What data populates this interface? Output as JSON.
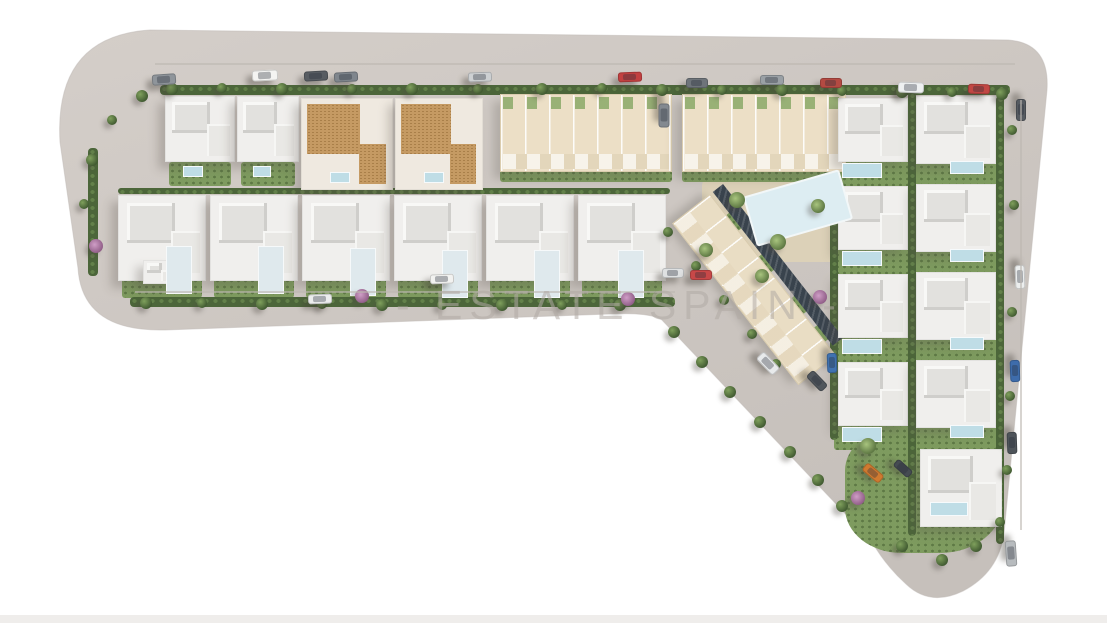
{
  "watermark": {
    "text": "- ESTATE SPAIN -"
  },
  "palette": {
    "background": "#ffffff",
    "pavement": "#cdc7c2",
    "pavement_light": "#d6d0cb",
    "villa_white": "#f0efed",
    "terracotta_roof": "#c59a63",
    "townhouse_cream": "#ecdfc6",
    "apartment_cream": "#e9ddc4",
    "dark_roof_band": "#39434d",
    "hedge_green": "#4c663a",
    "lawn_green": "#7e9b5f",
    "pool_blue": "#bfdde6",
    "communal_pool_blue": "#ddedf2",
    "watermark_gray": "rgba(176,170,164,0.55)"
  },
  "scene": {
    "land_path": "M150,30 L1008,40 Q1050,43 1047,90 L1004,533 Q999,572 963,591 Q930,607 906,584 Q886,566 872,542 L662,320 Q650,312 610,314 L165,330 Q82,332 78,268 L60,142 Q54,36 150,30 Z",
    "deck": [
      702,
      176,
      162,
      86,
      0
    ],
    "lawns": [
      [
        169,
        162,
        62,
        24
      ],
      [
        241,
        162,
        54,
        24
      ],
      [
        305,
        168,
        84,
        22
      ],
      [
        399,
        168,
        80,
        22
      ],
      [
        500,
        170,
        172,
        12
      ],
      [
        682,
        170,
        164,
        12
      ],
      [
        122,
        278,
        80,
        20
      ],
      [
        214,
        278,
        80,
        20
      ],
      [
        306,
        278,
        80,
        20
      ],
      [
        398,
        278,
        80,
        20
      ],
      [
        490,
        278,
        80,
        20
      ],
      [
        582,
        278,
        80,
        20
      ],
      [
        834,
        158,
        170,
        28
      ],
      [
        834,
        246,
        170,
        28
      ],
      [
        834,
        334,
        170,
        28
      ],
      [
        834,
        422,
        170,
        28
      ],
      [
        848,
        190,
        30,
        56
      ],
      [
        726,
        214,
        20,
        12,
        52
      ],
      [
        758,
        256,
        20,
        12,
        52
      ],
      [
        790,
        298,
        20,
        12,
        52
      ],
      [
        812,
        328,
        18,
        11,
        52
      ]
    ],
    "lawns_round": [
      [
        845,
        428,
        158,
        125
      ]
    ],
    "hedges": [
      [
        160,
        85,
        850,
        10
      ],
      [
        118,
        188,
        552,
        6
      ],
      [
        130,
        297,
        545,
        10
      ],
      [
        88,
        148,
        10,
        128
      ],
      [
        830,
        92,
        8,
        348
      ],
      [
        908,
        92,
        8,
        444
      ],
      [
        996,
        96,
        8,
        448
      ]
    ],
    "townhouses": [
      [
        500,
        94,
        172,
        78
      ],
      [
        682,
        94,
        164,
        78
      ]
    ],
    "apartment": [
      710,
      194,
      205,
      48,
      52
    ],
    "darkband": [
      723,
      184,
      195,
      13,
      52
    ],
    "villas": [
      [
        165,
        96,
        70,
        66,
        "w"
      ],
      [
        237,
        96,
        62,
        66,
        "w"
      ],
      [
        301,
        98,
        92,
        92,
        "t"
      ],
      [
        395,
        98,
        88,
        92,
        "t"
      ],
      [
        118,
        195,
        88,
        86,
        "w"
      ],
      [
        210,
        195,
        88,
        86,
        "w"
      ],
      [
        302,
        195,
        88,
        86,
        "w"
      ],
      [
        394,
        195,
        88,
        86,
        "w"
      ],
      [
        486,
        195,
        88,
        86,
        "w"
      ],
      [
        578,
        195,
        88,
        86,
        "w"
      ],
      [
        838,
        98,
        70,
        64,
        "w"
      ],
      [
        838,
        186,
        70,
        64,
        "w"
      ],
      [
        838,
        274,
        70,
        64,
        "w"
      ],
      [
        838,
        362,
        70,
        64,
        "w"
      ],
      [
        916,
        96,
        80,
        68,
        "w"
      ],
      [
        916,
        184,
        80,
        68,
        "w"
      ],
      [
        916,
        272,
        80,
        68,
        "w"
      ],
      [
        916,
        360,
        80,
        68,
        "w"
      ],
      [
        920,
        449,
        82,
        78,
        "w"
      ],
      [
        143,
        260,
        30,
        24,
        "w"
      ]
    ],
    "patios": [
      [
        166,
        246,
        26,
        48
      ],
      [
        258,
        246,
        26,
        48
      ],
      [
        350,
        248,
        26,
        48
      ],
      [
        442,
        250,
        26,
        48
      ],
      [
        534,
        250,
        26,
        48
      ],
      [
        618,
        250,
        26,
        48
      ]
    ],
    "pools": [
      [
        183,
        166,
        20,
        11
      ],
      [
        253,
        166,
        18,
        11
      ],
      [
        330,
        172,
        20,
        11
      ],
      [
        424,
        172,
        20,
        11
      ],
      [
        842,
        163,
        40,
        15
      ],
      [
        842,
        251,
        40,
        15
      ],
      [
        842,
        339,
        40,
        15
      ],
      [
        842,
        427,
        40,
        15
      ],
      [
        950,
        161,
        34,
        13
      ],
      [
        950,
        249,
        34,
        13
      ],
      [
        950,
        337,
        34,
        13
      ],
      [
        950,
        425,
        34,
        13
      ],
      [
        930,
        502,
        38,
        14
      ]
    ],
    "bigpool": [
      748,
      182,
      100,
      52,
      -16
    ],
    "trees": [
      [
        172,
        89,
        6,
        "g"
      ],
      [
        222,
        88,
        5,
        "g"
      ],
      [
        282,
        89,
        6,
        "g"
      ],
      [
        352,
        89,
        5,
        "g"
      ],
      [
        412,
        89,
        6,
        "g"
      ],
      [
        478,
        89,
        5,
        "g"
      ],
      [
        542,
        89,
        6,
        "g"
      ],
      [
        602,
        88,
        5,
        "g"
      ],
      [
        662,
        90,
        6,
        "g"
      ],
      [
        722,
        90,
        5,
        "g"
      ],
      [
        782,
        90,
        6,
        "g"
      ],
      [
        842,
        91,
        5,
        "g"
      ],
      [
        902,
        92,
        6,
        "g"
      ],
      [
        952,
        92,
        5,
        "g"
      ],
      [
        1002,
        94,
        6,
        "g"
      ],
      [
        146,
        303,
        6,
        "g"
      ],
      [
        202,
        303,
        5,
        "g"
      ],
      [
        262,
        304,
        6,
        "g"
      ],
      [
        322,
        304,
        5,
        "g"
      ],
      [
        382,
        305,
        6,
        "g"
      ],
      [
        442,
        305,
        5,
        "g"
      ],
      [
        502,
        305,
        6,
        "g"
      ],
      [
        562,
        305,
        5,
        "g"
      ],
      [
        620,
        305,
        6,
        "g"
      ],
      [
        362,
        296,
        7,
        "k"
      ],
      [
        628,
        299,
        7,
        "k"
      ],
      [
        820,
        297,
        7,
        "k"
      ],
      [
        96,
        246,
        7,
        "k"
      ],
      [
        858,
        498,
        7,
        "k"
      ],
      [
        92,
        160,
        6,
        "g"
      ],
      [
        84,
        204,
        5,
        "g"
      ],
      [
        112,
        120,
        5,
        "g"
      ],
      [
        142,
        96,
        6,
        "g"
      ],
      [
        1012,
        130,
        5,
        "g"
      ],
      [
        1014,
        205,
        5,
        "g"
      ],
      [
        1012,
        312,
        5,
        "g"
      ],
      [
        1010,
        396,
        5,
        "g"
      ],
      [
        1007,
        470,
        5,
        "g"
      ],
      [
        737,
        200,
        8,
        "p"
      ],
      [
        778,
        242,
        8,
        "p"
      ],
      [
        818,
        206,
        7,
        "p"
      ],
      [
        762,
        276,
        7,
        "p"
      ],
      [
        706,
        250,
        7,
        "p"
      ],
      [
        674,
        332,
        6,
        "g"
      ],
      [
        702,
        362,
        6,
        "g"
      ],
      [
        730,
        392,
        6,
        "g"
      ],
      [
        760,
        422,
        6,
        "g"
      ],
      [
        790,
        452,
        6,
        "g"
      ],
      [
        818,
        480,
        6,
        "g"
      ],
      [
        842,
        506,
        6,
        "g"
      ],
      [
        868,
        446,
        8,
        "p"
      ],
      [
        902,
        546,
        6,
        "g"
      ],
      [
        942,
        560,
        6,
        "g"
      ],
      [
        976,
        546,
        6,
        "g"
      ],
      [
        1000,
        522,
        5,
        "g"
      ],
      [
        668,
        232,
        5,
        "g"
      ],
      [
        696,
        266,
        5,
        "g"
      ],
      [
        724,
        300,
        5,
        "g"
      ],
      [
        752,
        334,
        5,
        "g"
      ],
      [
        776,
        364,
        5,
        "g"
      ]
    ],
    "cars": [
      [
        152,
        74,
        24,
        11,
        -4,
        "#8f959b"
      ],
      [
        252,
        70,
        26,
        11,
        -3,
        "#f4f4f2"
      ],
      [
        304,
        71,
        24,
        10,
        -3,
        "#585d63"
      ],
      [
        334,
        72,
        24,
        10,
        -3,
        "#7f868d"
      ],
      [
        468,
        72,
        24,
        10,
        -2,
        "#cdd0d2"
      ],
      [
        618,
        72,
        24,
        10,
        -2,
        "#c24040"
      ],
      [
        686,
        78,
        22,
        10,
        0,
        "#6e747a"
      ],
      [
        760,
        75,
        24,
        10,
        0,
        "#9aa0a5"
      ],
      [
        820,
        78,
        22,
        10,
        0,
        "#b44a42"
      ],
      [
        898,
        82,
        26,
        11,
        2,
        "#eef0f1"
      ],
      [
        968,
        84,
        22,
        10,
        2,
        "#c14743"
      ],
      [
        1010,
        105,
        22,
        10,
        90,
        "#565b61"
      ],
      [
        652,
        110,
        24,
        11,
        90,
        "#838990"
      ],
      [
        1008,
        272,
        24,
        10,
        88,
        "#eceeee"
      ],
      [
        1004,
        366,
        22,
        10,
        88,
        "#3e6cab"
      ],
      [
        1001,
        438,
        22,
        10,
        88,
        "#4e545a"
      ],
      [
        998,
        548,
        26,
        11,
        86,
        "#b7bbbe"
      ],
      [
        862,
        468,
        22,
        10,
        40,
        "#cf7a30"
      ],
      [
        893,
        464,
        20,
        9,
        42,
        "#454b52"
      ],
      [
        756,
        358,
        24,
        11,
        46,
        "#e8eaeb"
      ],
      [
        806,
        376,
        22,
        10,
        46,
        "#50565c"
      ],
      [
        822,
        358,
        20,
        10,
        88,
        "#4072b0"
      ],
      [
        308,
        294,
        24,
        10,
        -2,
        "#ecedee"
      ],
      [
        430,
        274,
        24,
        10,
        -2,
        "#f2f2f0"
      ],
      [
        662,
        268,
        22,
        10,
        0,
        "#dfe1e2"
      ],
      [
        690,
        270,
        22,
        10,
        0,
        "#c84848"
      ]
    ],
    "roadlines": [
      [
        155,
        63,
        860,
        2
      ],
      [
        1020,
        100,
        2,
        430
      ],
      [
        135,
        291,
        540,
        2
      ]
    ],
    "strips": [
      [
        0,
        615,
        1107,
        8
      ]
    ]
  }
}
